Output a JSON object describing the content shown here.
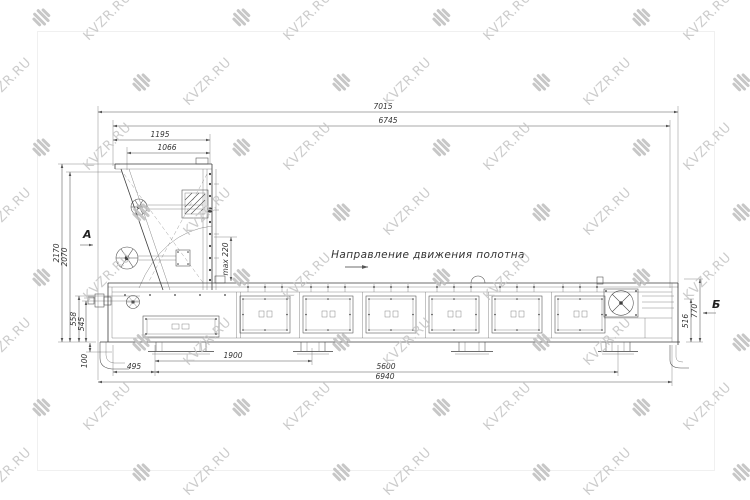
{
  "colors": {
    "background": "#ffffff",
    "line": "#3d3d3d",
    "dimension_line": "#555555",
    "dimension_text": "#333333",
    "watermark_text": "#c7c7c7",
    "watermark_icon": "#c2c2c2"
  },
  "watermark": {
    "text": "KVZR.RU",
    "icon": "kvzr-logo-icon"
  },
  "drawing": {
    "direction_label": "Направление движения полотна",
    "views": {
      "a": "А",
      "b": "Б"
    },
    "dims": {
      "overall_length": "7015",
      "body_length": "6745",
      "head_width": "1195",
      "head_inner_width": "1066",
      "overall_height": "2170",
      "hopper_height": "2070",
      "left_h1": "558",
      "left_h2": "545",
      "leg_height": "100",
      "right_cover_height": "770",
      "right_belt_height": "516",
      "bottom_offset": "495",
      "support_span": "1900",
      "frame_length": "5600",
      "base_length": "6940",
      "product_note": "max 220"
    }
  }
}
